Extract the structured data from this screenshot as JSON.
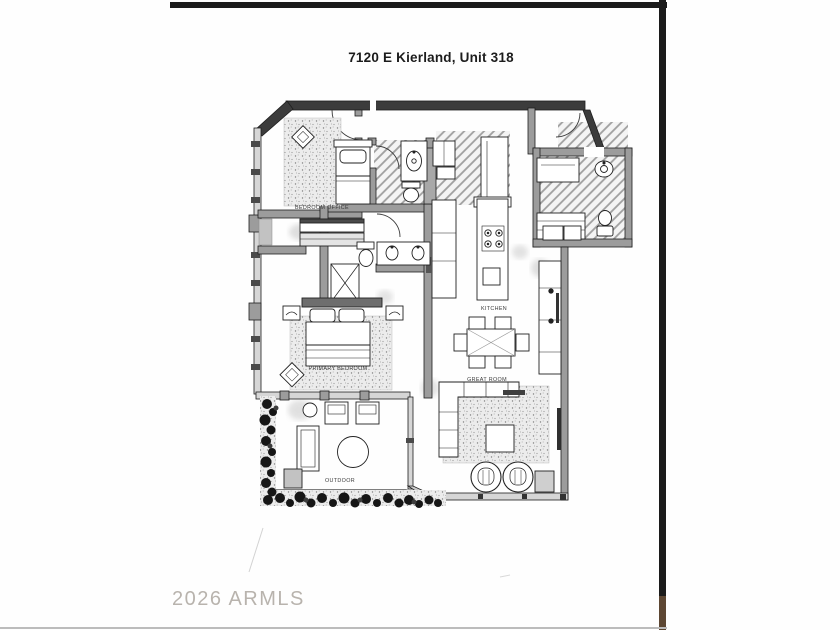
{
  "page": {
    "title": "7120 E Kierland, Unit 318",
    "watermark": "2026 ARMLS"
  },
  "rooms": {
    "bedroom_office": "BEDROOM OFFICE",
    "primary_bedroom": "PRIMARY BEDROOM",
    "kitchen": "KITCHEN",
    "great_room": "GREAT ROOM",
    "outdoor": "OUTDOOR"
  },
  "colors": {
    "exterior_wall": "#3c3c3c",
    "interior_wall": "#9c9c9c",
    "scan_bar": "#1b1b1b",
    "watermark_gray": "#aca69f",
    "plant_dark": "#161616"
  }
}
